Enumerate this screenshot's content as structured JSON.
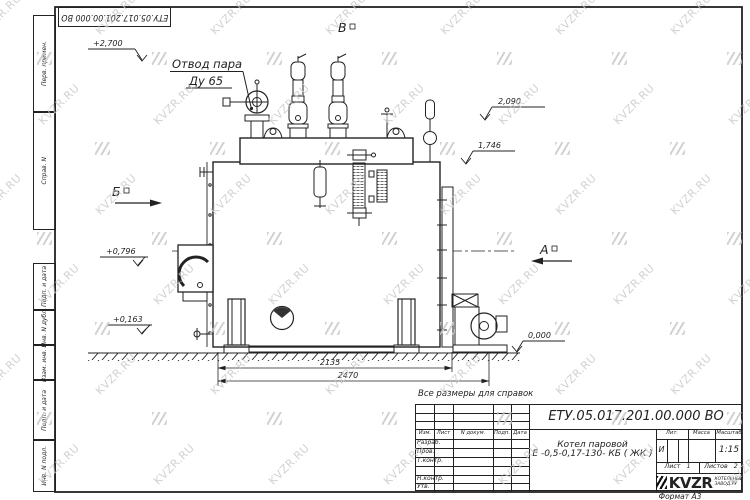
{
  "watermark": {
    "text": "KVZR.RU"
  },
  "sheet": {
    "top_stamp": "ЕТУ.05.017.201.00.000  ВО",
    "format_label": "Формат А3",
    "note": "Все размеры для справок",
    "side_fields_top": [
      "Перв. примен.",
      "Справ. N"
    ],
    "side_fields_bottom": [
      "Подп. и дата",
      "Инв. N дубл.",
      "Взам. инв. N",
      "Подп. и дата",
      "Инв. N подл."
    ]
  },
  "drawing": {
    "callout_line1": "Отвод пара",
    "callout_line2": "Ду 65",
    "view_top": "В",
    "view_left": "Б",
    "view_right": "А",
    "elev_top": "+2,700",
    "elev_r1": "2,090",
    "elev_r2": "1,746",
    "elev_l1": "+0,796",
    "elev_l2": "+0,163",
    "elev_ground": "0,000",
    "dim_inner": "2135",
    "dim_outer": "2470"
  },
  "title_block": {
    "doc_number": "ЕТУ.05.017.201.00.000  ВО",
    "product_line1": "Котел паровой",
    "product_line2": "Е -0,5-0,17-130- КБ ( ЖК )",
    "col_izm": "Изм.",
    "col_list": "Лист",
    "col_ndocum": "N докум.",
    "col_podp": "Подп.",
    "col_data": "Дата",
    "rows": [
      "Разраб.",
      "Пров.",
      "Т.контр.",
      "",
      "Н.контр.",
      "Утв."
    ],
    "lit_header": "Лит.",
    "mass_header": "Масса",
    "scale_header": "Масштаб",
    "lit_value": "И",
    "mass_value": "",
    "scale_value": "1:15",
    "sheet_label": "Лист",
    "sheet_value": "1",
    "sheets_label": "Листов",
    "sheets_value": "2",
    "logo_text": "KVZR",
    "logo_sub1": "КОТЕЛЬНЫЙ",
    "logo_sub2": "ЗАВОД.РУ"
  }
}
